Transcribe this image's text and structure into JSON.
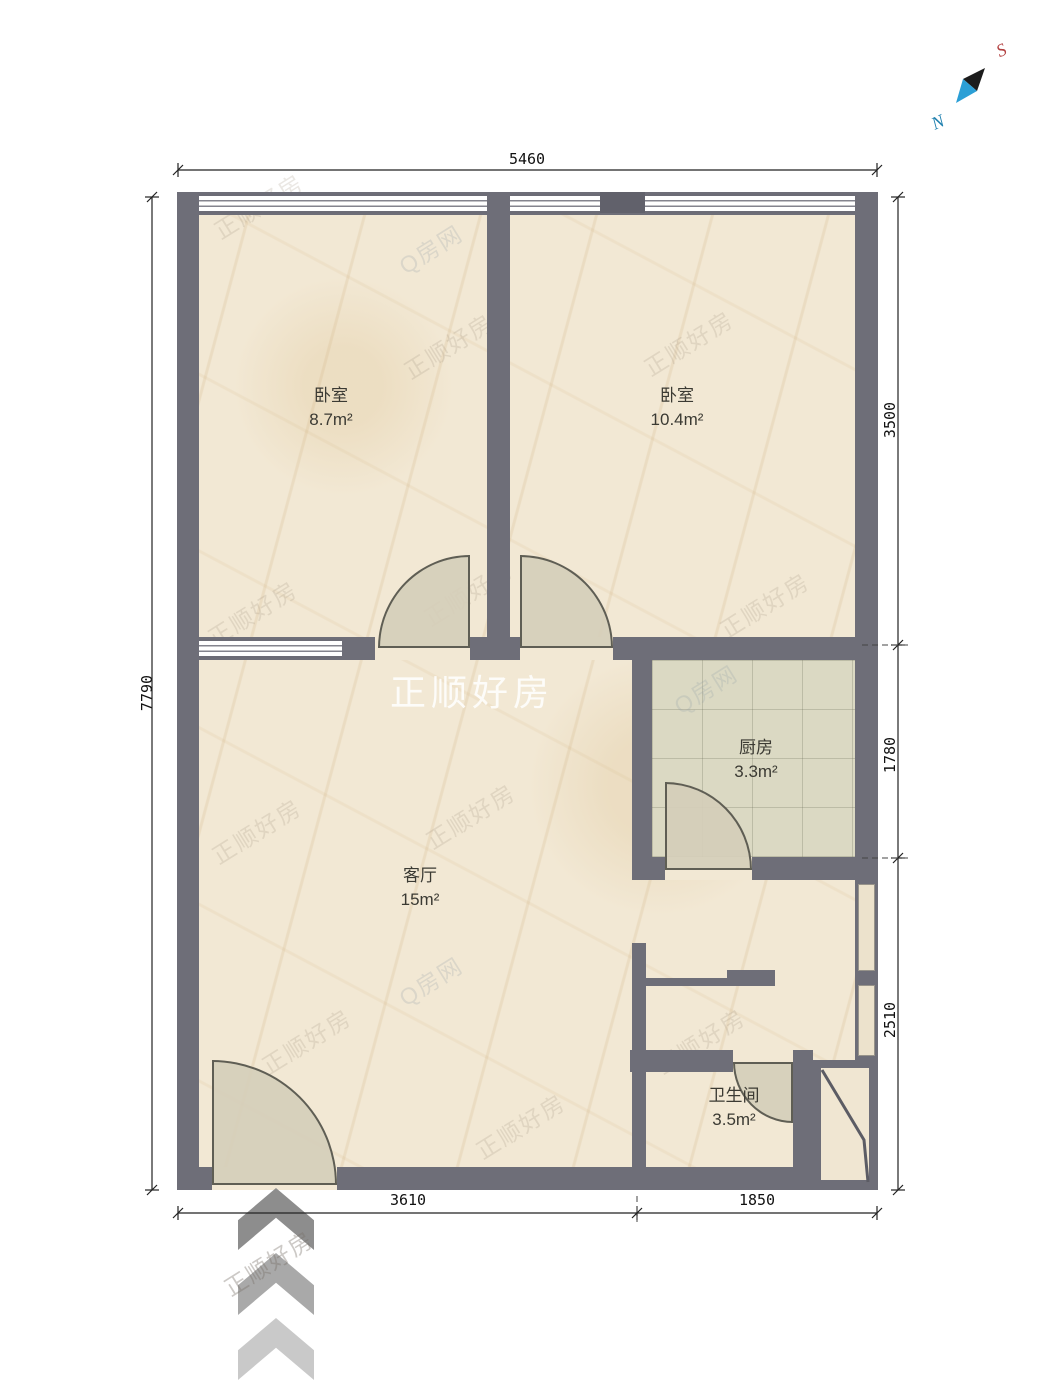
{
  "plan": {
    "type": "residential-floor-plan"
  },
  "rooms": [
    {
      "name": "卧室",
      "area": "8.7m²"
    },
    {
      "name": "卧室",
      "area": "10.4m²"
    },
    {
      "name": "客厅",
      "area": "15m²"
    },
    {
      "name": "厨房",
      "area": "3.3m²"
    },
    {
      "name": "卫生间",
      "area": "3.5m²"
    }
  ],
  "dimensions": {
    "top": "5460",
    "left": "7790",
    "right": [
      "3500",
      "1780",
      "2510"
    ],
    "bottom": [
      "3610",
      "1850"
    ]
  },
  "compass": {
    "south_label": "S",
    "north_label": "N"
  },
  "watermark": {
    "brand": "正顺好房",
    "alt": "Q房网"
  },
  "colors": {
    "wall": "#6e6e78",
    "floor": "#f2e8d4",
    "kitchen_tile": "#dbd9c3",
    "door_fill": "#d5cfba",
    "compass_south": "#b24040",
    "compass_north": "#1d7fae"
  }
}
